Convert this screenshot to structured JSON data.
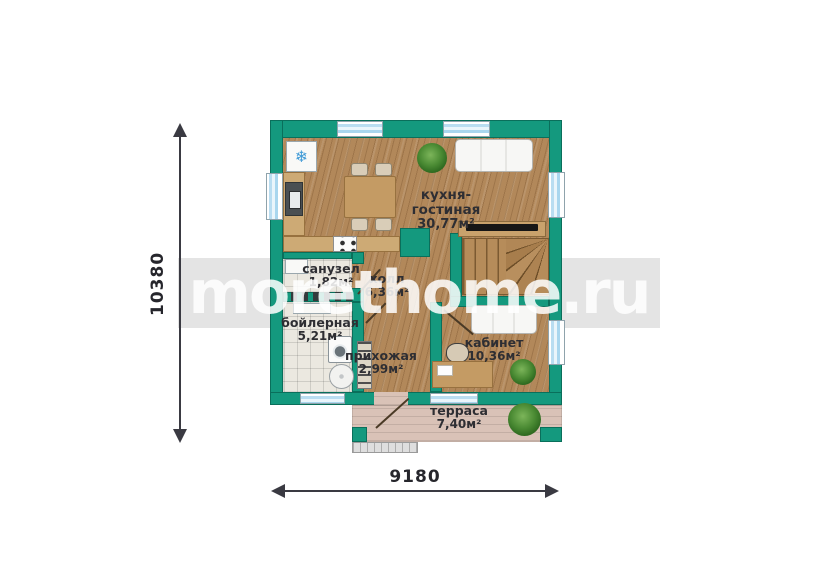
{
  "watermark": {
    "text": "morethome.ru",
    "text_color": "#ffffff"
  },
  "dimensions": {
    "vertical": "10380",
    "horizontal": "9180"
  },
  "rooms": [
    {
      "name": "кухня-гостиная",
      "area": "30,77м²"
    },
    {
      "name": "санузел",
      "area": "1,82м²"
    },
    {
      "name": "холл",
      "area": "6,36м²"
    },
    {
      "name": "бойлерная",
      "area": "5,21м²"
    },
    {
      "name": "прихожая",
      "area": "2,99м²"
    },
    {
      "name": "кабинет",
      "area": "10,36м²"
    },
    {
      "name": "терраса",
      "area": "7,40м²"
    }
  ],
  "icons": {
    "snowflake": "❄"
  },
  "fixtures": [
    "fridge",
    "kitchen-sink",
    "stove",
    "dining-table",
    "dining-chairs",
    "sofa",
    "tv",
    "stairs",
    "bathroom-sink",
    "radiator",
    "washing-machine",
    "boiler-tank",
    "shoe-ladder",
    "office-sofa",
    "desk",
    "office-chair",
    "plants",
    "door-swings",
    "entrance-steps"
  ],
  "colors": {
    "wall": "#14997e",
    "glass": "#b9ddf1",
    "wood": "#b2885a",
    "tile": "#ebe8e0",
    "deck": "#d9c2b7",
    "ink": "#2e2e33",
    "dim": "#3a3a42",
    "watermark_band": "#e4e4e4"
  }
}
